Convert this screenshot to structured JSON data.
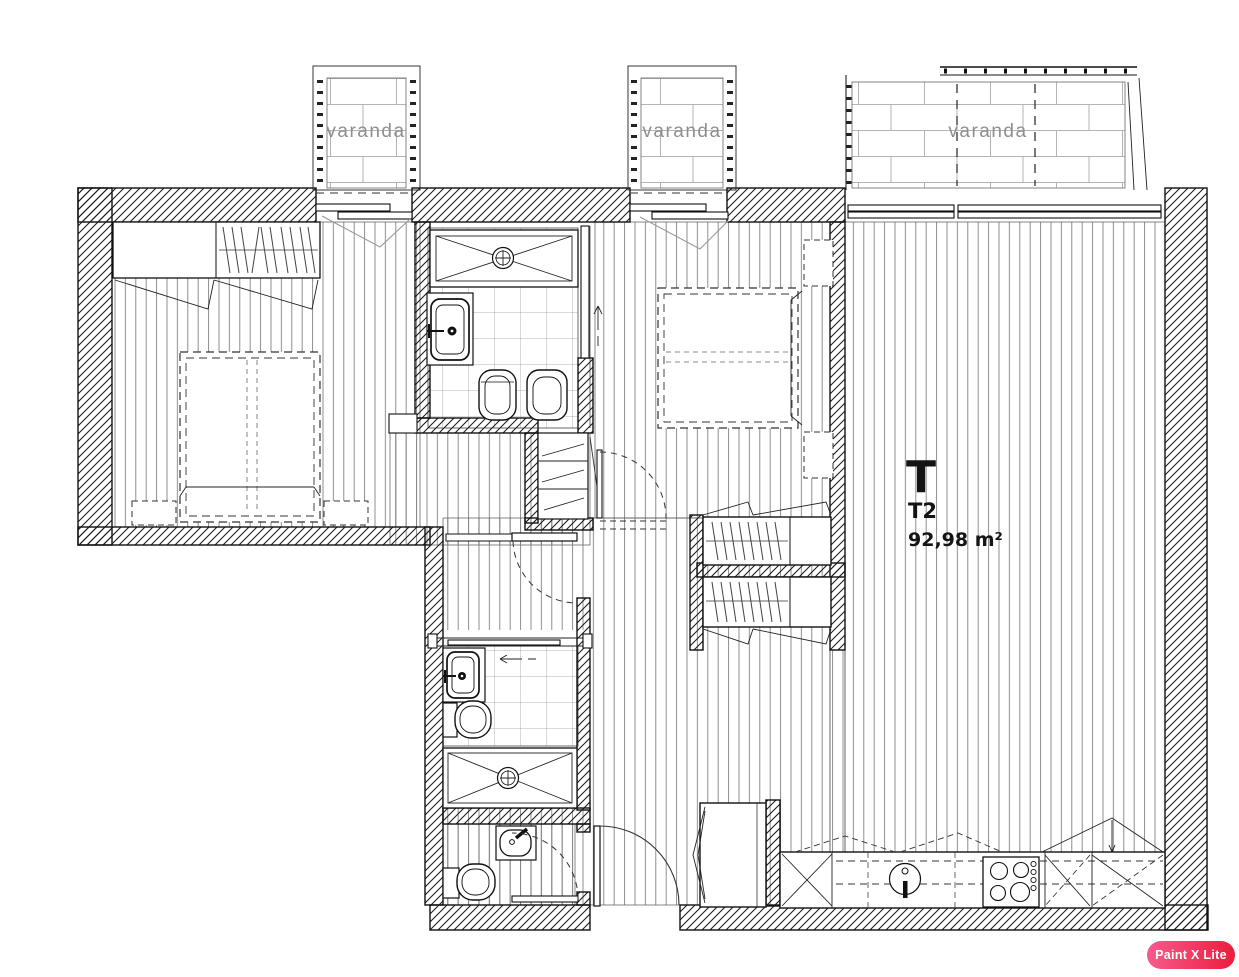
{
  "unit": {
    "letter": "T",
    "code": "T2",
    "area": "92,98 m²"
  },
  "balconies": [
    {
      "label": "varanda"
    },
    {
      "label": "varanda"
    },
    {
      "label": "varanda"
    }
  ],
  "watermark": {
    "label": "Paint X Lite"
  },
  "colors": {
    "ink": "#1a1a1a",
    "floor_hatch_line": "#828282",
    "tile_line": "#9c9c9c",
    "brick_line": "#b3b3b3",
    "balcony_label": "#8f8f8f",
    "watermark_gradient_from": "#f75b8c",
    "watermark_gradient_to": "#ec1d3f",
    "watermark_text": "#ffffff"
  }
}
